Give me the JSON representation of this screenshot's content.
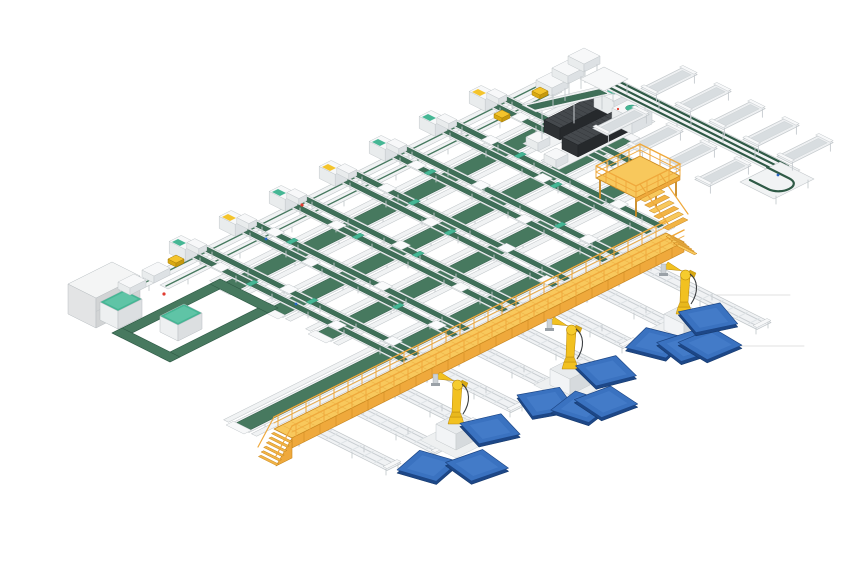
{
  "scene": {
    "label": "isometric-3d-render-of-automated-conveyor-sorting-factory",
    "width": 860,
    "height": 580,
    "background": "#ffffff",
    "origin": {
      "x": 60,
      "y": 150
    },
    "palette": {
      "beltGreen": "#47795f",
      "beltGreenDark": "#2f5a46",
      "laneGreen": "#3f6f58",
      "railWhite": "#f1f3f4",
      "railEdge": "#c3c8cb",
      "structGray": "#dde1e4",
      "plate": "#fafbfc",
      "teal": "#45b694",
      "tealDark": "#2e8f73",
      "amber": "#efa93c",
      "amberLight": "#f8c85c",
      "amberMid": "#f2b445",
      "amberDark": "#c9871f",
      "robotYellow": "#f2c120",
      "robotYellowDark": "#b8860b",
      "robotShade": "#d9a912",
      "pedestal": "#e8ebed",
      "pedestalSide": "#d6dadd",
      "palletTop": "#3a72c0",
      "palletSide": "#1d4787",
      "palletEdge": "#163a6e",
      "palletSheen": "#5088d2",
      "machineTop": "#45494d",
      "machineLeft": "#2e3134",
      "machineRight": "#26292c",
      "machineRib": "#33363a",
      "white": "#f7f8f9",
      "whiteL": "#e9eced",
      "whiteR": "#dde1e4",
      "legGray": "#c6cbcf",
      "floorLine": "#dcdcdc",
      "red": "#e03c31",
      "blue": "#2766c4",
      "yellowItem": "#f4c42c"
    },
    "floor_lines": [
      {
        "x1": 700,
        "y1": 295,
        "x2": 790,
        "y2": 295
      },
      {
        "x1": 728,
        "y1": 346,
        "x2": 804,
        "y2": 346
      }
    ],
    "rows": [
      {
        "v": 90,
        "u0": -58,
        "u1": 152,
        "w": 5,
        "style": "rail"
      },
      {
        "v": 97,
        "u0": -45,
        "u1": 152,
        "w": 4,
        "style": "rail"
      },
      {
        "v": 106,
        "u0": -30,
        "u1": 150,
        "w": 2.4,
        "style": "thinrail"
      },
      {
        "v": 113,
        "u0": -30,
        "u1": 150,
        "w": 9,
        "style": "belt"
      },
      {
        "v": 120,
        "u0": -30,
        "u1": 150,
        "w": 2.6,
        "style": "thinrail"
      },
      {
        "v": 130,
        "u0": -30,
        "u1": 146,
        "w": 2.4,
        "style": "thinrail"
      },
      {
        "v": 137,
        "u0": -30,
        "u1": 146,
        "w": 9,
        "style": "belt"
      },
      {
        "v": 144,
        "u0": -30,
        "u1": 146,
        "w": 2.6,
        "style": "thinrail"
      },
      {
        "v": 154,
        "u0": -30,
        "u1": 130,
        "w": 2.4,
        "style": "thinrail"
      },
      {
        "v": 161,
        "u0": -30,
        "u1": 130,
        "w": 9,
        "style": "belt"
      },
      {
        "v": 168,
        "u0": -30,
        "u1": 130,
        "w": 2.6,
        "style": "thinrail"
      },
      {
        "v": 179,
        "u0": -96,
        "u1": 106,
        "w": 2.4,
        "style": "thinrail"
      },
      {
        "v": 186,
        "u0": -96,
        "u1": 106,
        "w": 9,
        "style": "belt"
      },
      {
        "v": 193,
        "u0": -96,
        "u1": 106,
        "w": 2.6,
        "style": "thinrail"
      }
    ],
    "columns": [
      {
        "u": -19,
        "v1": 196,
        "accent": "teal",
        "plates": [
          [
            -3,
            100
          ],
          [
            3,
            128
          ],
          [
            -3,
            158
          ],
          [
            3,
            180
          ]
        ],
        "clamps": [
          [
            -3,
            117
          ],
          [
            3,
            141
          ]
        ]
      },
      {
        "u": 6,
        "v1": 196,
        "accent": "amber",
        "plates": [
          [
            3,
            96
          ],
          [
            -3,
            120
          ],
          [
            3,
            150
          ],
          [
            -3,
            183
          ]
        ],
        "clamps": [
          [
            3,
            106
          ],
          [
            -3,
            165
          ]
        ]
      },
      {
        "u": 31,
        "v1": 196,
        "accent": "teal",
        "plates": [
          [
            -3,
            108
          ],
          [
            3,
            134
          ],
          [
            -3,
            170
          ]
        ],
        "clamps": [
          [
            -3,
            120
          ],
          [
            3,
            144
          ]
        ]
      },
      {
        "u": 56,
        "v1": 196,
        "accent": "amber",
        "plates": [
          [
            3,
            102
          ],
          [
            -3,
            130
          ],
          [
            3,
            162
          ],
          [
            -3,
            188
          ]
        ],
        "clamps": [
          [
            3,
            117
          ],
          [
            -3,
            141
          ]
        ]
      },
      {
        "u": 81,
        "v1": 196,
        "accent": "teal",
        "plates": [
          [
            -3,
            98
          ],
          [
            3,
            124
          ],
          [
            -3,
            152
          ],
          [
            3,
            178
          ]
        ],
        "clamps": [
          [
            -3,
            106
          ],
          [
            3,
            165
          ]
        ]
      },
      {
        "u": 106,
        "v1": 193,
        "accent": "teal",
        "plates": [
          [
            3,
            104
          ],
          [
            -3,
            136
          ],
          [
            3,
            168
          ]
        ],
        "clamps": [
          [
            3,
            120
          ],
          [
            -3,
            144
          ]
        ]
      },
      {
        "u": 131,
        "v1": 168,
        "accent": "amber",
        "plates": [
          [
            -3,
            100
          ],
          [
            3,
            126
          ],
          [
            -3,
            150
          ]
        ],
        "clamps": [
          [
            -3,
            117
          ]
        ]
      }
    ],
    "machines": [
      {
        "u0": 122,
        "u1": 160,
        "v0": 116,
        "v1": 124
      },
      {
        "u0": 118,
        "u1": 156,
        "v0": 129,
        "v1": 137
      }
    ],
    "top_tables": [
      {
        "u": 148,
        "v": 98
      },
      {
        "u": 158,
        "v": 96
      },
      {
        "u": 168,
        "v": 94
      }
    ],
    "desc_feeder": {
      "u0": 122,
      "u1": 160,
      "v0": 109,
      "v1": 116,
      "h0": 32,
      "h1": 12
    },
    "right_arm": {
      "u0": 162,
      "u1": 170,
      "v0": 104,
      "v1": 200,
      "h": 10
    },
    "corner_box": {
      "u0": 160,
      "u1": 172,
      "v0": 100,
      "v1": 112
    },
    "end_uturn": {
      "u0": 150,
      "u1": 170,
      "v0": 190,
      "v1": 207
    },
    "troughs_right": {
      "u0": 172,
      "u1": 193,
      "vs": [
        122,
        139,
        156,
        173,
        190
      ]
    },
    "troughs_left": {
      "u0": 140,
      "u1": 161,
      "vs": [
        130,
        147,
        164,
        181
      ]
    },
    "loop": {
      "u0": -80,
      "u1": -26,
      "v0": 106,
      "v1": 135,
      "w": 5
    },
    "big_cabinet": {
      "u0": -80,
      "u1": -58,
      "v0": 84,
      "v1": 98,
      "h": 30
    },
    "small_cabinets": [
      {
        "u0": -75,
        "u1": -63,
        "v0": 95,
        "v1": 104,
        "h": 18
      },
      {
        "u0": -66,
        "u1": -54,
        "v0": 116,
        "v1": 125,
        "h": 16
      }
    ],
    "left_tables": [
      {
        "u": -52,
        "v": 88
      },
      {
        "u": -40,
        "v": 88
      }
    ],
    "platform": {
      "u0": 110,
      "u1": 132,
      "v0": 158,
      "v1": 178,
      "h": 20,
      "railH": 32,
      "stairs": {
        "u0": 112,
        "u1": 122,
        "steps": 6
      }
    },
    "walkway": {
      "u0": -96,
      "u1": 100,
      "v0": 203,
      "v1": 212,
      "h": 20,
      "railH": 32,
      "stairSteps": 6
    },
    "connectors": [
      {
        "u": -46
      },
      {
        "u": -24
      },
      {
        "u": 0
      },
      {
        "u": 24
      },
      {
        "u": 48
      }
    ],
    "stubs": [
      {
        "u": -78,
        "len": 36
      },
      {
        "u": -58,
        "len": 40
      },
      {
        "u": -38,
        "len": 34
      },
      {
        "u": -18,
        "len": 38
      },
      {
        "u": 2,
        "len": 36
      },
      {
        "u": 22,
        "len": 40
      },
      {
        "u": 42,
        "len": 34
      },
      {
        "u": 62,
        "len": 38
      },
      {
        "u": 85,
        "len": 58
      }
    ],
    "stub_v0": 209,
    "robots": [
      {
        "u": -46,
        "v": 244
      },
      {
        "u": 10,
        "v": 245
      },
      {
        "u": 66,
        "v": 246
      }
    ],
    "pallets": [
      {
        "u": -33.5,
        "v": 248.5,
        "r": 20
      },
      {
        "u": -67.5,
        "v": 251.5,
        "r": -15
      },
      {
        "u": -55,
        "v": 263.5,
        "r": 10
      },
      {
        "u": -6,
        "v": 249,
        "r": 25
      },
      {
        "u": 0.5,
        "v": 260.5,
        "r": -12
      },
      {
        "u": 9,
        "v": 264,
        "r": 8
      },
      {
        "u": 24.5,
        "v": 248.5,
        "r": 18
      },
      {
        "u": 51,
        "v": 247,
        "r": -18
      },
      {
        "u": 57.5,
        "v": 256.5,
        "r": 12
      },
      {
        "u": 64,
        "v": 261,
        "r": 5
      },
      {
        "u": 76.5,
        "v": 247.5,
        "r": 22
      }
    ],
    "pallet_half": 8,
    "yellow_items": [
      {
        "u": -30,
        "v": 88
      },
      {
        "u": 124,
        "v": 97
      },
      {
        "u": 145,
        "v": 95
      }
    ],
    "red_dots": [
      {
        "u": -49,
        "v": 101
      },
      {
        "u": 30,
        "v": 91
      }
    ],
    "blue_dots": [
      {
        "u": 3,
        "v": 100
      },
      {
        "u": -22,
        "v": 140
      },
      {
        "u": 163,
        "v": 196
      }
    ],
    "objects": {
      "belt_conveyor_rows": 4,
      "sorting_column_lines": 7,
      "processing_machines": 2,
      "robot_arms": 3,
      "blue_pallets": 11,
      "trough_conveyors": 9,
      "outfeed_stub_conveyors": 9,
      "operator_platforms": 1,
      "elevated_walkways": 1,
      "control_cabinets": 3,
      "buffer_loops": 1
    }
  }
}
